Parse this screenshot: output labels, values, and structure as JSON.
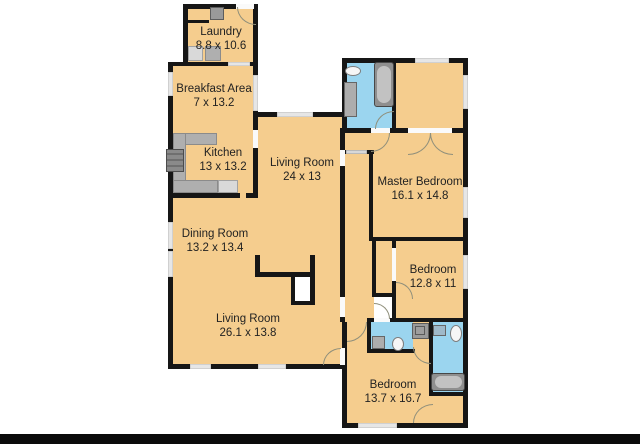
{
  "title": "Residential floor plan",
  "colors": {
    "bg": "#FFFFFF",
    "room_fill": "#F5CD8E",
    "bath_fill": "#9BD5EF",
    "wall": "#161616",
    "window": "#E6E6E6",
    "door_arc": "#8F8F7B",
    "counter": "#AFAFAF",
    "counter_light": "#D9D9D9",
    "appliance": "#9A9A9A",
    "label": "#222222",
    "bottom_bar": "#0B0B0B"
  },
  "rooms": {
    "laundry": {
      "name": "Laundry",
      "dims": "8.8 x 10.6"
    },
    "breakfast": {
      "name": "Breakfast Area",
      "dims": "7 x 13.2"
    },
    "kitchen": {
      "name": "Kitchen",
      "dims": "13 x 13.2"
    },
    "living_upper": {
      "name": "Living Room",
      "dims": "24 x 13"
    },
    "dining": {
      "name": "Dining Room",
      "dims": "13.2 x 13.4"
    },
    "living_lower": {
      "name": "Living Room",
      "dims": "26.1 x 13.8"
    },
    "master": {
      "name": "Master Bedroom",
      "dims": "16.1 x 14.8"
    },
    "bedroom_mid": {
      "name": "Bedroom",
      "dims": "12.8 x 11"
    },
    "bedroom_bottom": {
      "name": "Bedroom",
      "dims": "13.7 x 16.7"
    }
  },
  "fixtures": [
    "washer",
    "dryer",
    "stove",
    "kitchen-counter",
    "dishwasher",
    "bathtub",
    "sink",
    "toilet",
    "shower",
    "fireplace",
    "closet"
  ]
}
